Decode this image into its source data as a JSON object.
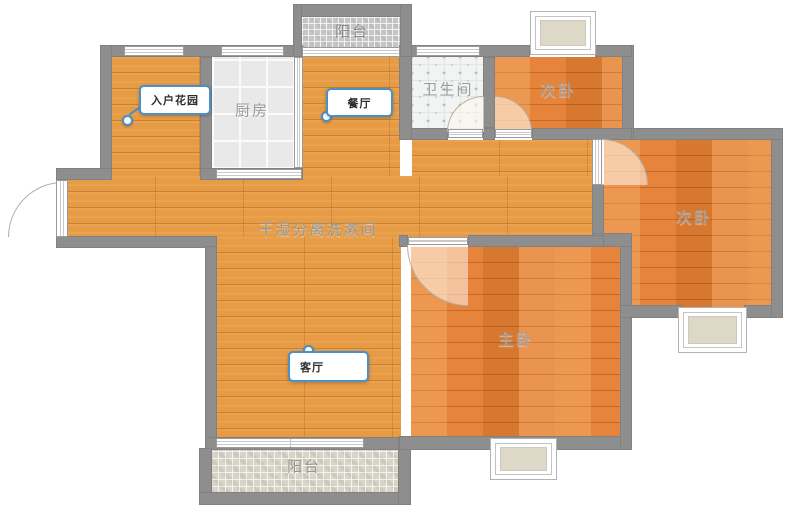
{
  "plan": {
    "title": "三室两厅户型图",
    "labels": {
      "balcony_top": "阳台",
      "entry_garden": "入户花园",
      "kitchen": "厨房",
      "dining": "餐厅",
      "bathroom": "卫生间",
      "bedroom_top": "次卧",
      "bedroom_right": "次卧",
      "hallway": "干湿分离洗漱间",
      "living": "客厅",
      "master": "主卧",
      "balcony_bottom": "阳台"
    },
    "colors": {
      "wall": "#8e8e8e",
      "wood_hall": "#e69b44",
      "wood_bedroom": "#e5843a",
      "kitchen_tile": "#e9e9e9",
      "bath_tile": "#f1f4f2",
      "balcony_top_mosaic": "#c6c6c6",
      "balcony_bottom_mosaic": "#d8d4c8",
      "bay_window_fill": "#ddd8c8",
      "tag_accent": "#4a90c8",
      "floor_text": "#949a9c"
    }
  }
}
